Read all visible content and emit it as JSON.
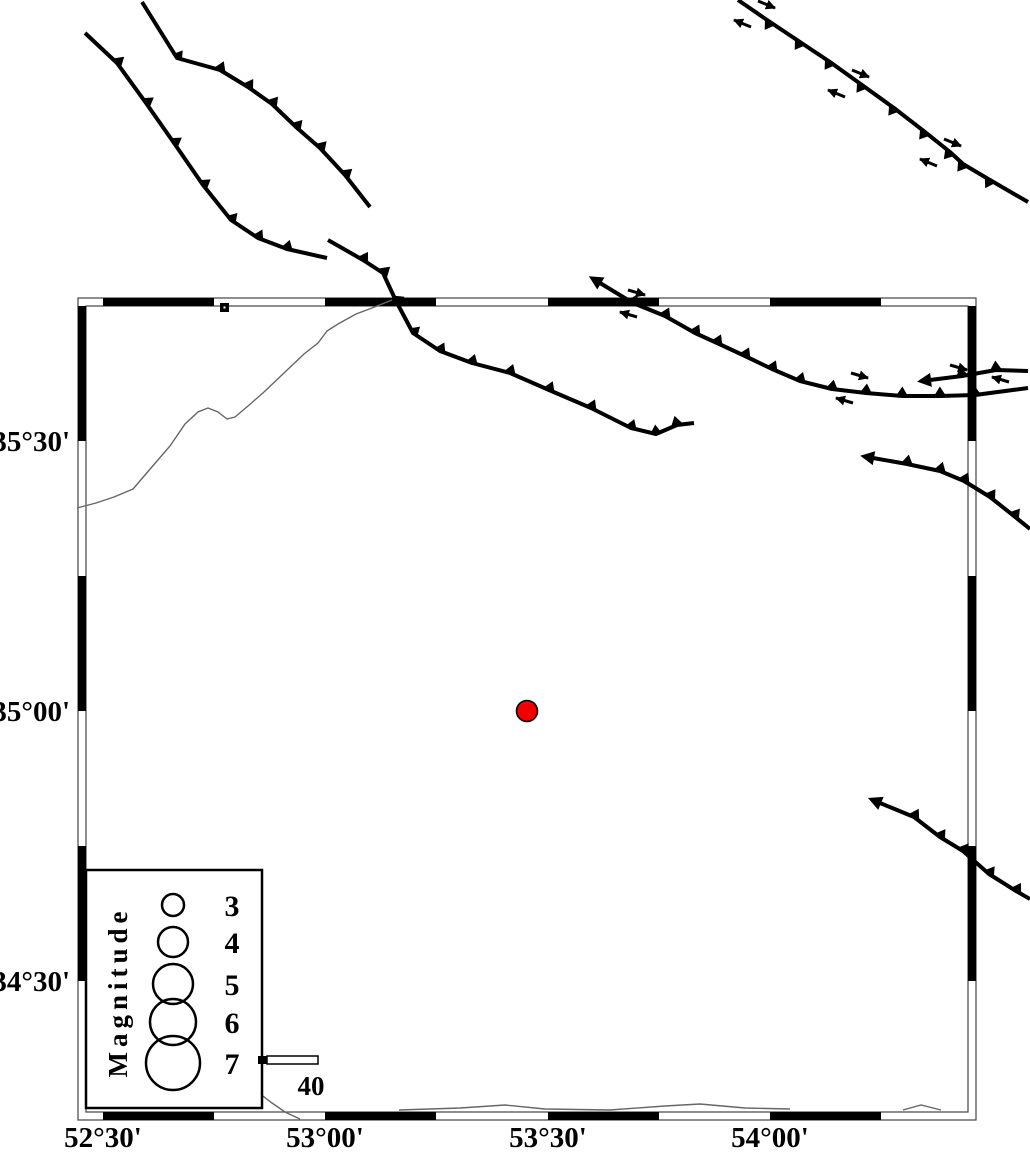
{
  "figure": {
    "width": 1030,
    "height": 1152,
    "background": "#ffffff"
  },
  "colors": {
    "linework": "#000000",
    "frame_line": "#444444",
    "river": "#666666",
    "epicenter_fill": "#f20000",
    "epicenter_stroke": "#000000"
  },
  "frame": {
    "outer": {
      "x": 78,
      "y": 298,
      "w": 898,
      "h": 822
    },
    "inner": {
      "x": 86,
      "y": 306,
      "w": 882,
      "h": 806
    },
    "bar": 8,
    "x_black": [
      [
        103,
        214
      ],
      [
        325,
        436
      ],
      [
        548,
        659
      ],
      [
        770,
        881
      ]
    ],
    "y_black": [
      [
        306,
        441
      ],
      [
        576,
        711
      ],
      [
        846,
        981
      ]
    ]
  },
  "axis": {
    "x_labels": [
      {
        "label": "52°30'",
        "x": 103,
        "y": 1147
      },
      {
        "label": "53°00'",
        "x": 325,
        "y": 1147
      },
      {
        "label": "53°30'",
        "x": 548,
        "y": 1147
      },
      {
        "label": "54°00'",
        "x": 770,
        "y": 1147
      }
    ],
    "y_labels": [
      {
        "label": "35°30'",
        "x": 70,
        "y": 451
      },
      {
        "label": "35°00'",
        "x": 70,
        "y": 721
      },
      {
        "label": "34°30'",
        "x": 70,
        "y": 991
      }
    ]
  },
  "epicenter": {
    "x": 527,
    "y": 711,
    "r": 10.5
  },
  "square_marker": {
    "x": 220,
    "y": 303,
    "size": 9,
    "dot_x": 223.5,
    "dot_y": 306.5,
    "dot_size": 2
  },
  "legend": {
    "box": {
      "x": 86,
      "y": 870,
      "w": 176,
      "h": 238
    },
    "title": "Magnitude",
    "title_x": 121,
    "title_y": 998,
    "title_transform": "rotate(-90 121 992)",
    "entries": [
      {
        "label": "3",
        "cx": 173,
        "cy": 905,
        "r": 11,
        "lx": 232,
        "ly": 916
      },
      {
        "label": "4",
        "cx": 173,
        "cy": 942,
        "r": 15,
        "lx": 232,
        "ly": 953
      },
      {
        "label": "5",
        "cx": 173,
        "cy": 984,
        "r": 20,
        "lx": 232,
        "ly": 995
      },
      {
        "label": "6",
        "cx": 173,
        "cy": 1022,
        "r": 23,
        "lx": 232,
        "ly": 1033
      },
      {
        "label": "7",
        "cx": 173,
        "cy": 1063,
        "r": 27,
        "lx": 232,
        "ly": 1074
      }
    ],
    "scale": {
      "cap": {
        "x": 258,
        "y": 1056,
        "w": 9,
        "h": 8
      },
      "bar": {
        "x": 267,
        "y": 1056,
        "w": 51,
        "h": 8
      },
      "label": "40",
      "label_x": 311,
      "label_y": 1095
    }
  },
  "faults": [
    {
      "name": "fault-nw-a",
      "teeth": "up",
      "start_arrow": false,
      "points": [
        [
          85,
          33
        ],
        [
          117,
          63
        ],
        [
          146,
          103
        ],
        [
          174,
          143
        ],
        [
          203,
          185
        ],
        [
          231,
          220
        ],
        [
          258,
          238
        ],
        [
          287,
          249
        ],
        [
          327,
          258
        ]
      ]
    },
    {
      "name": "fault-nw-b",
      "teeth": "up",
      "start_arrow": false,
      "points": [
        [
          142,
          2
        ],
        [
          177,
          58
        ],
        [
          220,
          70
        ],
        [
          248,
          87
        ],
        [
          272,
          104
        ],
        [
          296,
          127
        ],
        [
          320,
          148
        ],
        [
          345,
          175
        ],
        [
          370,
          207
        ]
      ]
    },
    {
      "name": "fault-central",
      "teeth": "up",
      "start_arrow": false,
      "points": [
        [
          328,
          240
        ],
        [
          363,
          260
        ],
        [
          383,
          273
        ],
        [
          396,
          301
        ],
        [
          413,
          333
        ],
        [
          440,
          351
        ],
        [
          472,
          363
        ],
        [
          510,
          373
        ],
        [
          549,
          390
        ],
        [
          591,
          408
        ],
        [
          631,
          428
        ],
        [
          656,
          434
        ],
        [
          677,
          425
        ],
        [
          694,
          423
        ]
      ]
    },
    {
      "name": "fault-ne",
      "teeth": "down",
      "start_arrow": false,
      "points": [
        [
          738,
          0
        ],
        [
          770,
          22
        ],
        [
          800,
          42
        ],
        [
          830,
          62
        ],
        [
          862,
          85
        ],
        [
          894,
          108
        ],
        [
          925,
          132
        ],
        [
          950,
          152
        ],
        [
          963,
          164
        ],
        [
          990,
          180
        ],
        [
          1028,
          202
        ]
      ]
    },
    {
      "name": "fault-east-long",
      "teeth": "up",
      "start_arrow": true,
      "points": [
        [
          600,
          283
        ],
        [
          633,
          303
        ],
        [
          665,
          316
        ],
        [
          695,
          333
        ],
        [
          717,
          343
        ],
        [
          745,
          356
        ],
        [
          772,
          369
        ],
        [
          800,
          381
        ],
        [
          832,
          389
        ],
        [
          866,
          393
        ],
        [
          902,
          396
        ],
        [
          940,
          396
        ],
        [
          975,
          395
        ],
        [
          1028,
          388
        ]
      ]
    },
    {
      "name": "fault-east-short",
      "teeth": "up",
      "start_arrow": true,
      "points": [
        [
          930,
          380
        ],
        [
          962,
          376
        ],
        [
          996,
          370
        ],
        [
          1028,
          371
        ]
      ]
    },
    {
      "name": "fault-east-mid",
      "teeth": "up",
      "start_arrow": true,
      "points": [
        [
          873,
          458
        ],
        [
          907,
          464
        ],
        [
          940,
          471
        ],
        [
          964,
          481
        ],
        [
          990,
          497
        ],
        [
          1014,
          516
        ],
        [
          1030,
          529
        ]
      ]
    },
    {
      "name": "fault-se",
      "teeth": "up",
      "start_arrow": true,
      "points": [
        [
          880,
          803
        ],
        [
          914,
          817
        ],
        [
          940,
          837
        ],
        [
          963,
          851
        ],
        [
          989,
          874
        ],
        [
          1016,
          891
        ],
        [
          1030,
          899
        ]
      ]
    }
  ],
  "slip_arrows": [
    {
      "from": [
        758,
        1
      ],
      "to": [
        775,
        8
      ]
    },
    {
      "from": [
        751,
        27
      ],
      "to": [
        734,
        20
      ]
    },
    {
      "from": [
        852,
        70
      ],
      "to": [
        869,
        77
      ]
    },
    {
      "from": [
        845,
        97
      ],
      "to": [
        828,
        90
      ]
    },
    {
      "from": [
        944,
        139
      ],
      "to": [
        961,
        146
      ]
    },
    {
      "from": [
        937,
        166
      ],
      "to": [
        920,
        159
      ]
    },
    {
      "from": [
        628,
        290
      ],
      "to": [
        645,
        295
      ]
    },
    {
      "from": [
        637,
        317
      ],
      "to": [
        620,
        312
      ]
    },
    {
      "from": [
        851,
        373
      ],
      "to": [
        868,
        378
      ]
    },
    {
      "from": [
        853,
        403
      ],
      "to": [
        836,
        398
      ]
    },
    {
      "from": [
        950,
        365
      ],
      "to": [
        967,
        370
      ]
    },
    {
      "from": [
        1009,
        382
      ],
      "to": [
        992,
        377
      ]
    }
  ],
  "rivers": [
    {
      "name": "river-main",
      "points": [
        [
          77,
          508
        ],
        [
          96,
          503
        ],
        [
          114,
          497
        ],
        [
          133,
          489
        ],
        [
          151,
          468
        ],
        [
          170,
          446
        ],
        [
          185,
          424
        ],
        [
          198,
          412
        ],
        [
          208,
          408
        ],
        [
          218,
          412
        ],
        [
          227,
          419
        ],
        [
          235,
          417
        ],
        [
          248,
          406
        ],
        [
          264,
          392
        ],
        [
          284,
          373
        ],
        [
          304,
          354
        ],
        [
          318,
          343
        ],
        [
          327,
          331
        ],
        [
          338,
          324
        ],
        [
          356,
          314
        ],
        [
          372,
          308
        ],
        [
          392,
          300
        ]
      ]
    },
    {
      "name": "stream-bottom-long",
      "points": [
        [
          399,
          1110
        ],
        [
          460,
          1108
        ],
        [
          505,
          1105
        ],
        [
          545,
          1109
        ],
        [
          610,
          1110
        ],
        [
          665,
          1106
        ],
        [
          700,
          1104
        ],
        [
          745,
          1108
        ],
        [
          790,
          1109
        ]
      ]
    },
    {
      "name": "stream-bottom-right",
      "points": [
        [
          903,
          1110
        ],
        [
          921,
          1105
        ],
        [
          941,
          1110
        ]
      ]
    },
    {
      "name": "stream-legend-corner",
      "points": [
        [
          259,
          1093
        ],
        [
          272,
          1103
        ],
        [
          285,
          1112
        ],
        [
          300,
          1119
        ]
      ]
    }
  ]
}
